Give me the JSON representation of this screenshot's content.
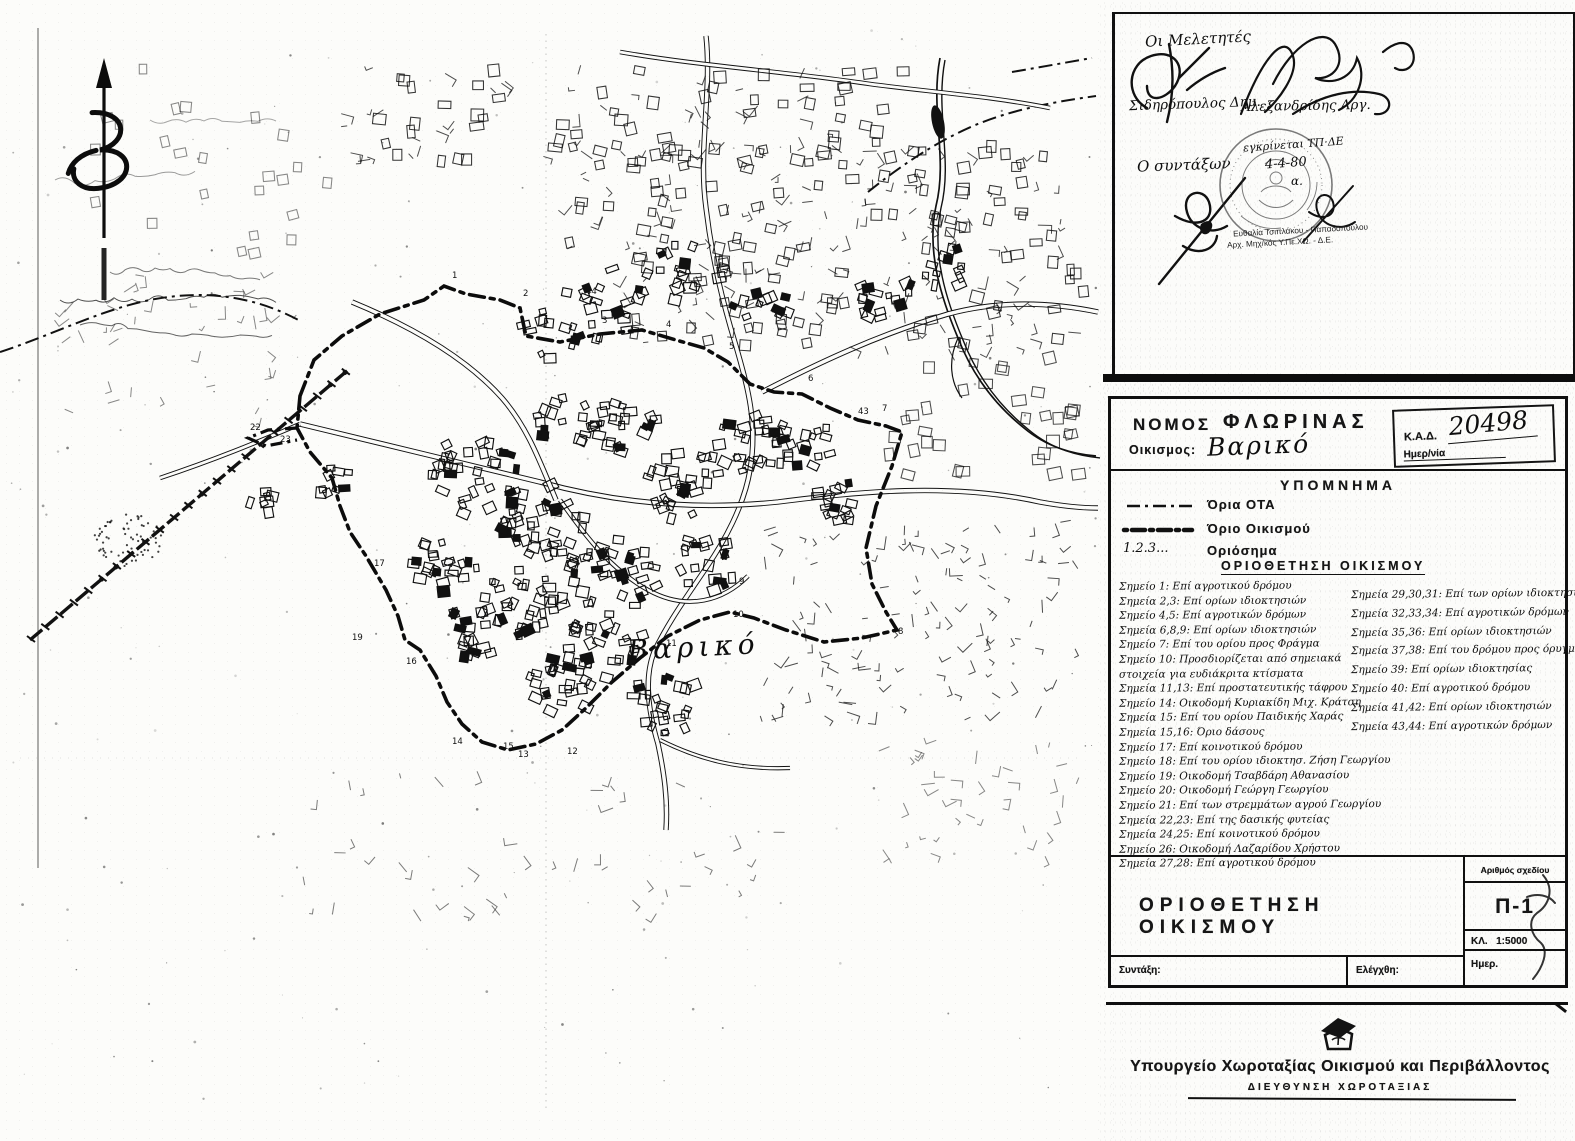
{
  "map": {
    "settlement_label": "Βαρικό",
    "north_label": "Β",
    "boundary_markers": [
      {
        "n": "1",
        "x": 452,
        "y": 278
      },
      {
        "n": "2",
        "x": 523,
        "y": 296
      },
      {
        "n": "3",
        "x": 602,
        "y": 323
      },
      {
        "n": "4",
        "x": 666,
        "y": 327
      },
      {
        "n": "5",
        "x": 729,
        "y": 349
      },
      {
        "n": "6",
        "x": 808,
        "y": 381
      },
      {
        "n": "7",
        "x": 882,
        "y": 411
      },
      {
        "n": "8",
        "x": 898,
        "y": 634
      },
      {
        "n": "9",
        "x": 739,
        "y": 584
      },
      {
        "n": "10",
        "x": 733,
        "y": 617
      },
      {
        "n": "11",
        "x": 666,
        "y": 646
      },
      {
        "n": "12",
        "x": 567,
        "y": 754
      },
      {
        "n": "13",
        "x": 518,
        "y": 757
      },
      {
        "n": "14",
        "x": 452,
        "y": 744
      },
      {
        "n": "15",
        "x": 503,
        "y": 749
      },
      {
        "n": "16",
        "x": 406,
        "y": 664
      },
      {
        "n": "17",
        "x": 374,
        "y": 566
      },
      {
        "n": "19",
        "x": 352,
        "y": 640
      },
      {
        "n": "22",
        "x": 250,
        "y": 430
      },
      {
        "n": "23",
        "x": 280,
        "y": 442
      },
      {
        "n": "43",
        "x": 858,
        "y": 414
      },
      {
        "n": "44",
        "x": 586,
        "y": 294
      }
    ]
  },
  "approval": {
    "designers_title": "Οι Μελετητές",
    "designer1": "Σιδηρόπουλος Δημ.",
    "designer2": "Αλεξανδρίδης Αργ.",
    "supervisor_title": "Ο συντάξων",
    "stamp_note_line1": "εγκρίνεται ΤΠ·ΔΕ",
    "stamp_note_line2": "4-4-80",
    "stamp_note_line3": "α.",
    "officer_name": "Ευθαλία Τσιπλάκου - Παπαδοπούλου",
    "officer_role": "Αρχ. Μηχ/κός Υ.Πε.ΧΩ. - Δ.Ε."
  },
  "header": {
    "prefecture_label": "ΝΟΜΟΣ",
    "prefecture_value": "ΦΛΩΡΙΝΑΣ",
    "settlement_label": "Οικισμος:",
    "settlement_value": "Βαρικό",
    "kad_label": "Κ.Α.Δ.",
    "kad_value": "20498",
    "date_label": "Ημερ/νία"
  },
  "legend": {
    "title": "ΥΠΟΜΝΗΜΑ",
    "items": [
      {
        "symbol": "dash-dot-line",
        "label": "Όρια ΟΤΑ"
      },
      {
        "symbol": "bold-dot-dash-line",
        "label": "Όριο Οικισμού"
      },
      {
        "symbol": "numbers",
        "symbol_text": "1.2.3...",
        "label": "Οριόσημα"
      }
    ],
    "section_heading": "ΟΡΙΟΘΕΤΗΣΗ ΟΙΚΙΣΜΟΥ"
  },
  "delimitation_notes": {
    "left_column": [
      "Σημείο 1: Επί αγροτικού δρόμου",
      "Σημεία 2,3: Επί ορίων ιδιοκτησιών",
      "Σημείο 4,5: Επί αγροτικών δρόμων",
      "Σημεία 6,8,9: Επί ορίων ιδιοκτησιών",
      "Σημείο 7: Επί του ορίου προς Φράγμα",
      "Σημείο 10: Προσδιορίζεται από σημειακά",
      "στοιχεία για ευδιάκριτα κτίσματα",
      "Σημεία 11,13: Επί προστατευτικής τάφρου",
      "Σημείο 14: Οικοδομή Κυριακίδη Μιχ. Κράτση",
      "Σημεία 15: Επί του ορίου Παιδικής Χαράς",
      "Σημεία 15,16: Όριο δάσους",
      "Σημείο 17: Επί κοινοτικού δρόμου",
      "Σημείο 18: Επί του ορίου ιδιοκτησ. Ζήση Γεωργίου",
      "Σημείο 19: Οικοδομή Τσαβδάρη Αθανασίου",
      "Σημείο 20: Οικοδομή Γεώργη Γεωργίου",
      "Σημείο 21: Επί των στρεμμάτων αγρού Γεωργίου",
      "Σημεία 22,23: Επί της δασικής φυτείας",
      "Σημεία 24,25: Επί κοινοτικού δρόμου",
      "Σημείο 26: Οικοδομή Λαζαρίδου Χρήστου",
      "Σημεία 27,28: Επί αγροτικού δρόμου"
    ],
    "right_column": [
      "Σημεία 29,30,31: Επί των ορίων ιδιοκτησιών",
      "Σημεία 32,33,34: Επί αγροτικών δρόμων",
      "Σημεία 35,36: Επί ορίων ιδιοκτησιών",
      "Σημεία 37,38: Επί του δρόμου προς όρυγμα",
      "Σημείο 39: Επί ορίων ιδιοκτησίας",
      "Σημείο 40: Επί αγροτικού δρόμου",
      "Σημεία 41,42: Επί ορίων ιδιοκτησιών",
      "Σημεία 43,44: Επί αγροτικών δρόμων"
    ]
  },
  "titleblock": {
    "title": "ΟΡΙΟΘΕΤΗΣΗ ΟΙΚΙΣΜΟΥ",
    "drawing_number_label": "Αριθμός σχεδίου",
    "drawing_number": "Π-1",
    "scale_label": "ΚΛ.",
    "scale_value": "1:5000",
    "prepared_label": "Συντάξη:",
    "checked_label": "Ελέγχθη:",
    "date_label": "Ημερ."
  },
  "footer": {
    "ministry": "Υπουργείο Χωροταξίας Οικισμού και Περιβάλλοντος",
    "directorate": "ΔΙΕΥΘΥΝΣΗ ΧΩΡΟΤΑΞΙΑΣ"
  },
  "colors": {
    "ink": "#141414",
    "paper": "#fcfcfa"
  }
}
